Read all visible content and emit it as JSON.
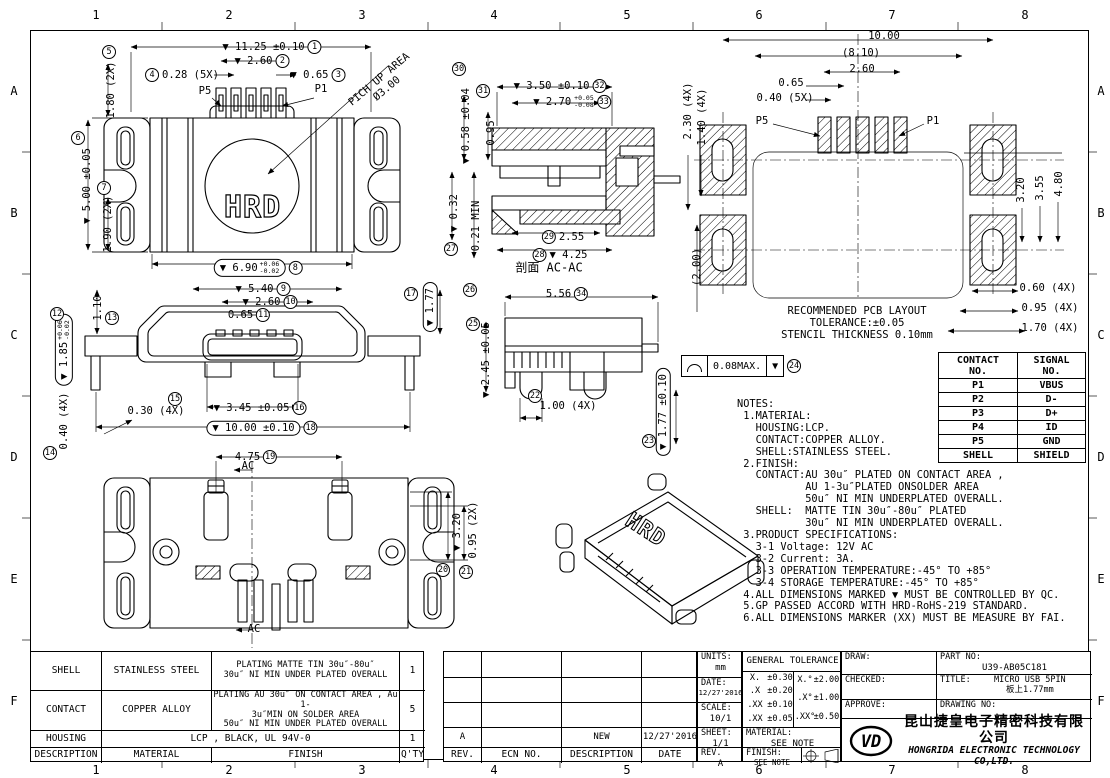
{
  "zones": {
    "cols": [
      "1",
      "2",
      "3",
      "4",
      "5",
      "6",
      "7",
      "8"
    ],
    "rows": [
      "A",
      "B",
      "C",
      "D",
      "E",
      "F"
    ]
  },
  "view_labels": {
    "p5": "P5",
    "p1": "P1",
    "pickup_line1": "PICH UP AREA",
    "pickup_line2": "Ø3.00",
    "hrd": "HRD",
    "section_title": "剖面 AC-AC",
    "ac": "AC"
  },
  "dims": {
    "d01": {
      "t": "▼ 11.25 ±0.10",
      "n": "1"
    },
    "d02": {
      "t": "▼ 2.60",
      "n": "2"
    },
    "d03": {
      "t": "▼ 0.65",
      "n": "3"
    },
    "d04": {
      "t": "0.28 (5X)",
      "n": "4"
    },
    "d05": {
      "t": "1.80 (2X)",
      "n": "5"
    },
    "d06": {
      "t": "▼ 5.00 ±0.05",
      "n": "6"
    },
    "d07": {
      "t": "1.90 (2X)",
      "n": "7"
    },
    "d08": {
      "t": "▼ 6.90",
      "up": "+0.06",
      "dn": "-0.02",
      "n": "8"
    },
    "d09": {
      "t": "▼ 5.40",
      "n": "9"
    },
    "d10": {
      "t": "▼ 2.60",
      "n": "10"
    },
    "d11": {
      "t": "0.65",
      "n": "11"
    },
    "d12": {
      "t": "▼ 1.85",
      "up": "+0.06",
      "dn": "-0.02",
      "n": "12"
    },
    "d13": {
      "t": "1.10",
      "n": "13"
    },
    "d14": {
      "t": "0.40 (4X)",
      "n": "14"
    },
    "d15": {
      "t": "0.30 (4X)",
      "n": "15"
    },
    "d16": {
      "t": "▼ 3.45 ±0.05",
      "n": "16"
    },
    "d17": {
      "t": "▼ 1.77",
      "n": "17"
    },
    "d18": {
      "t": "▼ 10.00 ±0.10",
      "n": "18"
    },
    "d19": {
      "t": "4.75",
      "n": "19"
    },
    "d20": {
      "t": "▼ 3.20",
      "n": "20"
    },
    "d21": {
      "t": "0.95 (2X)",
      "n": "21"
    },
    "d22": {
      "t": "1.00 (4X)",
      "n": "22"
    },
    "d23": {
      "t": "▼ 1.77 ±0.10",
      "n": "23"
    },
    "d24": {
      "t": "0.08MAX.",
      "n": "24"
    },
    "d25": {
      "t": "▼ 2.45 ±0.05",
      "n": "25"
    },
    "d26": {
      "t": "0.21 MIN",
      "n": "26"
    },
    "d27": {
      "t": "▼ 0.32",
      "n": "27"
    },
    "d28": {
      "t": "▼ 4.25",
      "n": "28"
    },
    "d29": {
      "t": "2.55",
      "n": "29"
    },
    "d30": {
      "t": "▼ 0.58 ±0.04",
      "n": "30"
    },
    "d31": {
      "t": "0.95",
      "n": "31"
    },
    "d32": {
      "t": "▼ 3.50 ±0.10",
      "n": "32"
    },
    "d33": {
      "t": "▼ 2.70",
      "up": "+0.05",
      "dn": "-0.08",
      "n": "33"
    },
    "d34": {
      "t": "5.56",
      "n": "34"
    }
  },
  "pcb": {
    "dim_10_00": "10.00",
    "dim_8_10": "(8.10)",
    "dim_2_60": "2.60",
    "dim_0_65": "0.65",
    "dim_0_40": "0.40 (5X)",
    "p5": "P5",
    "p1": "P1",
    "dim_2_30": "2.30 (4X)",
    "dim_1_40": "1.40 (4X)",
    "dim_2_00": "(2.00)",
    "dim_3_20": "3.20",
    "dim_3_55": "3.55",
    "dim_4_80": "4.80",
    "dim_0_60": "0.60 (4X)",
    "dim_0_95": "0.95 (4X)",
    "dim_1_70": "1.70 (4X)",
    "note_line1": "RECOMMENDED PCB LAYOUT",
    "note_line2": "TOLERANCE:±0.05",
    "note_line3": "STENCIL THICKNESS 0.10mm"
  },
  "flatness": {
    "value": "0.08MAX.",
    "mark": "▼",
    "num": "24"
  },
  "contact_table": {
    "col1_header": "CONTACT\nNO.",
    "col2_header": "SIGNAL\nNO.",
    "rows": [
      {
        "contact": "P1",
        "signal": "VBUS"
      },
      {
        "contact": "P2",
        "signal": "D-"
      },
      {
        "contact": "P3",
        "signal": "D+"
      },
      {
        "contact": "P4",
        "signal": "ID"
      },
      {
        "contact": "P5",
        "signal": "GND"
      },
      {
        "contact": "SHELL",
        "signal": "SHIELD"
      }
    ]
  },
  "notes": {
    "lines": [
      "NOTES:",
      " 1.MATERIAL:",
      "   HOUSING:LCP.",
      "   CONTACT:COPPER ALLOY.",
      "   SHELL:STAINLESS STEEL.",
      " 2.FINISH:",
      "   CONTACT:AU 30u″ PLATED ON CONTACT AREA ,",
      "           AU 1-3u″PLATED ONSOLDER AREA",
      "           50u″ NI MIN UNDERPLATED OVERALL.",
      "   SHELL:  MATTE TIN 30u″-80u″ PLATED",
      "           30u″ NI MIN UNDERPLATED OVERALL.",
      " 3.PRODUCT SPECIFICATIONS:",
      "   3-1 Voltage: 12V AC",
      "   3-2 Current: 3A.",
      "   3-3 OPERATION TEMPERATURE:-45° TO +85°",
      "   3-4 STORAGE TEMPERATURE:-45° TO +85°",
      " 4.ALL DIMENSIONS MARKED ▼ MUST BE CONTROLLED BY QC.",
      " 5.GP PASSED ACCORD WITH HRD-RoHS-219 STANDARD.",
      " 6.ALL DIMENSIONS MARKER (XX) MUST BE MEASURE BY FAI."
    ]
  },
  "material_table": {
    "rows": [
      {
        "description": "SHELL",
        "material": "STAINLESS STEEL",
        "finish": "PLATING MATTE TIN 30u″-80u″\n30u″ NI MIN UNDER PLATED OVERALL",
        "qty": "1"
      },
      {
        "description": "CONTACT",
        "material": "COPPER ALLOY",
        "finish": "PLATING AU 30u″  ON CONTACT AREA , Au 1-\n3u″MIN ON SOLDER AREA\n50u″ NI MIN UNDER PLATED OVERALL",
        "qty": "5"
      },
      {
        "description": "HOUSING",
        "material_finish": "LCP , BLACK, UL 94V-0",
        "qty": "1"
      }
    ],
    "headers": {
      "description": "DESCRIPTION",
      "material": "MATERIAL",
      "finish": "FINISH",
      "qty": "Q'TY"
    }
  },
  "revision_table": {
    "data_row": {
      "rev": "A",
      "ecn": "",
      "description": "NEW",
      "date": "12/27'2016"
    },
    "headers": {
      "rev": "REV.",
      "ecn": "ECN NO.",
      "description": "DESCRIPTION",
      "date": "DATE"
    }
  },
  "info_block": {
    "units_label": "UNITS:",
    "units": "mm",
    "date_label": "DATE:",
    "date": "12/27'2016",
    "scale_label": "SCALE:",
    "scale": "10/1",
    "sheet_label": "SHEET:",
    "sheet": "1/1",
    "rev_label": "REV.",
    "rev": "A",
    "tolerance_title": "GENERAL TOLERANCE",
    "linear": [
      {
        "k": "X.",
        "v": "±0.30"
      },
      {
        "k": ".X",
        "v": "±0.20"
      },
      {
        "k": ".XX",
        "v": "±0.10"
      },
      {
        "k": ".XX",
        "v": "±0.05"
      }
    ],
    "angular": [
      {
        "k": "X.°",
        "v": "±2.00°"
      },
      {
        "k": ".X°",
        "v": "±1.00°"
      },
      {
        "k": ".XX°",
        "v": "±0.50°"
      }
    ],
    "material_label": "MATERIAL:",
    "material": "SEE NOTE",
    "finish_label": "FINISH:",
    "finish": "SEE NOTE"
  },
  "title_block": {
    "draw_label": "DRAW:",
    "checked_label": "CHECKED:",
    "approve_label": "APPROVE:",
    "part_no_label": "PART NO:",
    "part_no": "U39-AB05C181",
    "title_label": "TITLE:",
    "title_line1": "MICRO USB 5PIN",
    "title_line2": "板上1.77mm",
    "drawing_no_label": "DRAWING NO:",
    "logo_text": "VD",
    "company_cn": "昆山捷皇电子精密科技有限公司",
    "company_en": "HONGRIDA ELECTRONIC TECHNOLOGY CO,LTD."
  }
}
